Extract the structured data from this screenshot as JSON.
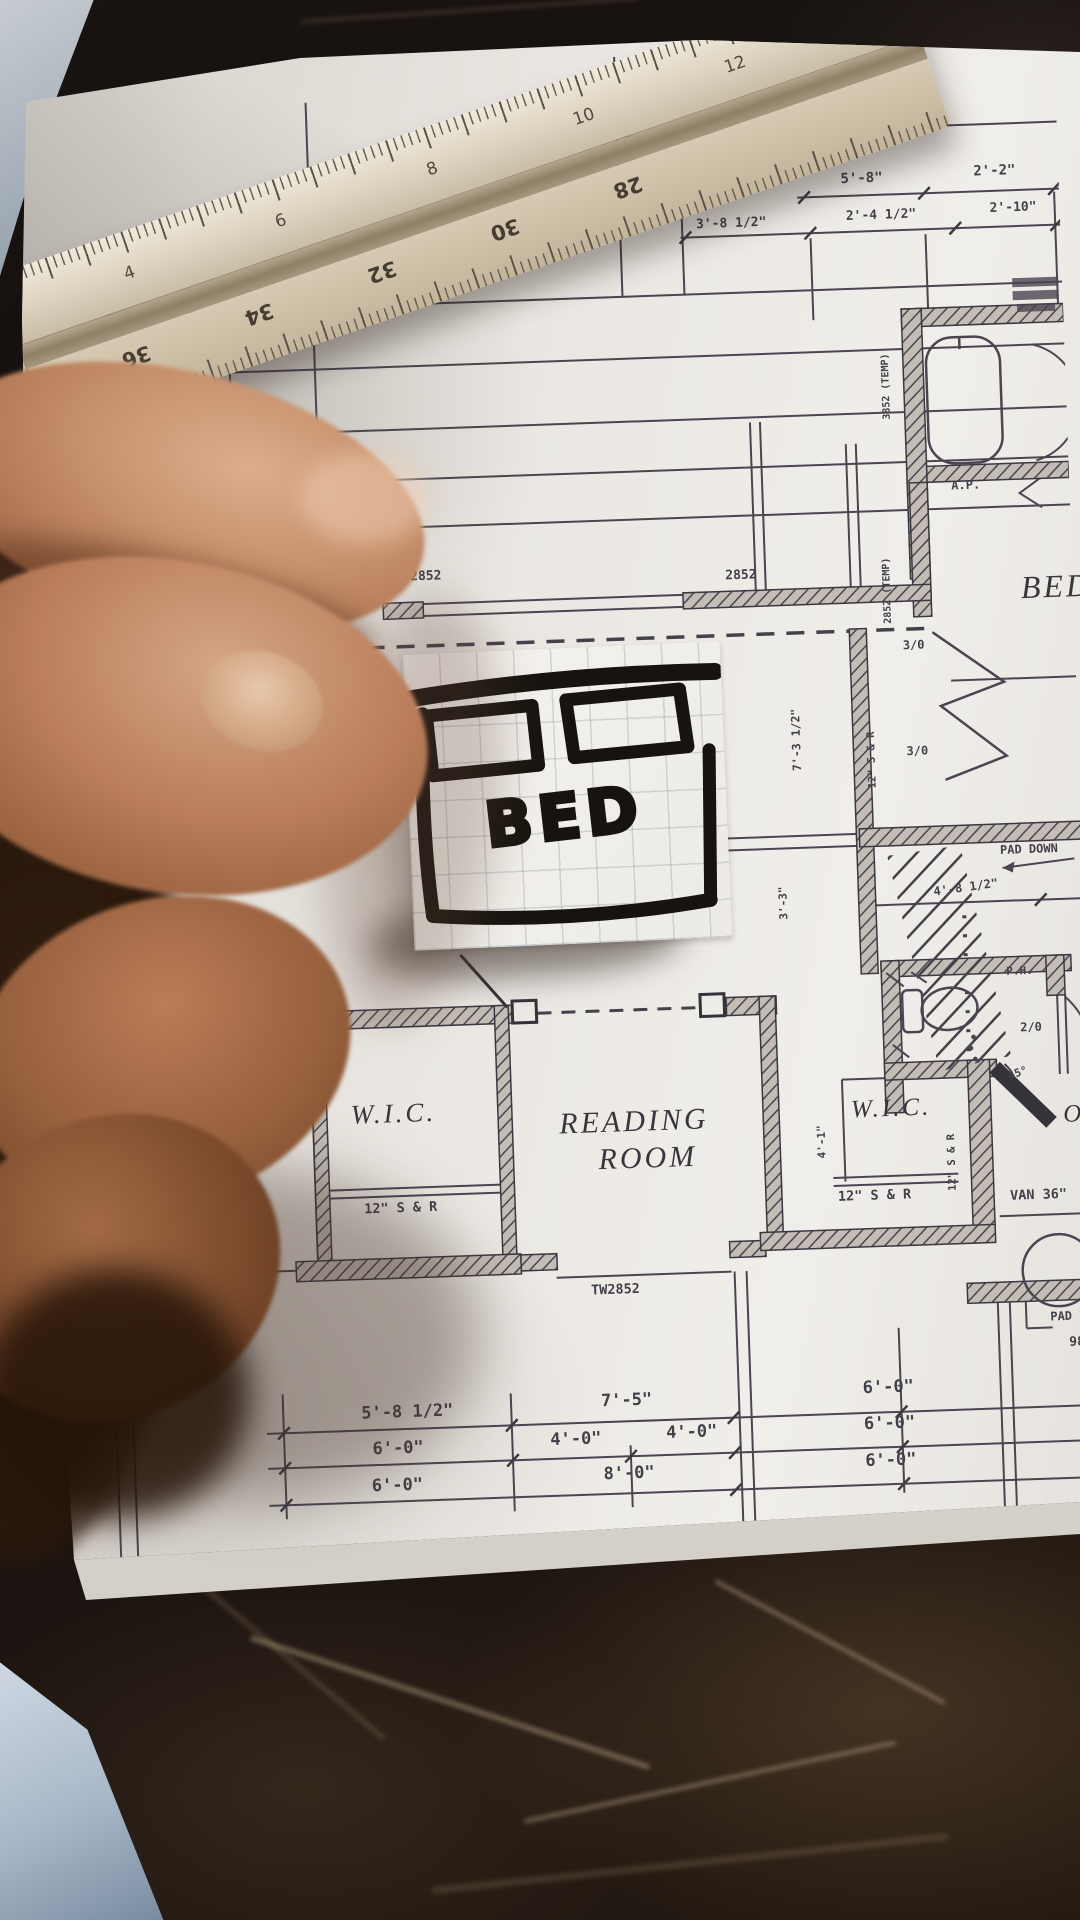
{
  "sticker": {
    "label": "BED"
  },
  "plan": {
    "rooms": {
      "bed": "BED",
      "wic_left": "W.I.C.",
      "reading1": "READING",
      "reading2": "ROOM",
      "wic_right": "W.I.C.",
      "partial_right": "OI"
    },
    "labels": {
      "w2852_a": "2852",
      "w2852_b": "2852",
      "temp_a": "3852 (TEMP)",
      "temp_b": "2852 (TEMP)",
      "ap": "A.P.",
      "ph": "P.H.",
      "d30": "3/0",
      "d20": "2/0",
      "a45": "45°",
      "pad_down": "PAD DOWN",
      "pad_d": "PAD D",
      "n98": "98",
      "sr": "12\" S & R",
      "van": "VAN 36\"",
      "tw2852": "TW2852"
    },
    "dims": {
      "top1": [
        "5'-8\"",
        "2'-2\""
      ],
      "top2": [
        "3'-8 1/2\"",
        "2'-4 1/2\"",
        "2'-10\""
      ],
      "left_rot": [
        "1'-6\"",
        "2'-0\"",
        "-0'-4 1/2\""
      ],
      "v7": "7'-3 1/2\"",
      "v3": "3'-3\"",
      "v41": "4'-1\"",
      "hatch": "4'-8 1/2\"",
      "b1": [
        "5'-8 1/2\"",
        "7'-5\"",
        "6'-0\""
      ],
      "b2": [
        "6'-0\"",
        "4'-0\"",
        "4'-0\"",
        "6'-0\""
      ],
      "b3": [
        "6'-0\"",
        "8'-0\"",
        "6'-0\""
      ]
    }
  },
  "ruler": {
    "top_scale": [
      "4",
      "6",
      "8",
      "10",
      "12"
    ],
    "bottom_scale": [
      "36",
      "34",
      "32",
      "30",
      "28"
    ]
  },
  "colors": {
    "ink": "#43404a",
    "wall": "#35323a",
    "page": "#eceae5",
    "marble": "#17110d",
    "ruler": "#d9cfbc",
    "skin": "#b5785a",
    "marker": "#17140f",
    "cloth": "#aebdce"
  }
}
